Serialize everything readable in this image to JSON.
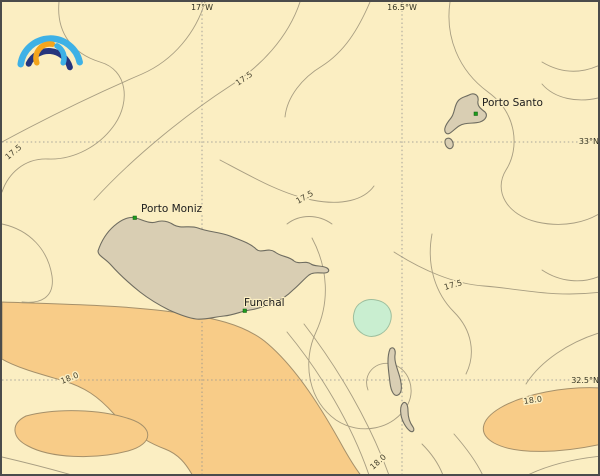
{
  "map": {
    "region": "Madeira archipelago contour map",
    "grid_labels": {
      "lon": [
        "17°W",
        "16.5°W"
      ],
      "lat": [
        "33°N",
        "32.5°N"
      ]
    },
    "cities": [
      {
        "name": "Porto Moniz"
      },
      {
        "name": "Funchal"
      },
      {
        "name": "Porto Santo"
      }
    ],
    "contour_levels": {
      "c175": "17.5",
      "c180": "18.0"
    },
    "colors": {
      "sea": "#FBEEC2",
      "warm_region": "#F8CC88",
      "warm_border": "#A5906A",
      "land": "#D9CEB3",
      "land_border": "#6E6C60",
      "cool_patch": "#C9EED0",
      "cool_border": "#9DBE9D",
      "contour": "#A89E82",
      "grid": "#8F8F8F",
      "city_marker": "#1E9C1E",
      "logo_light_blue": "#3EB1E6",
      "logo_dark_blue": "#26357E",
      "logo_orange": "#F4A51C"
    }
  }
}
